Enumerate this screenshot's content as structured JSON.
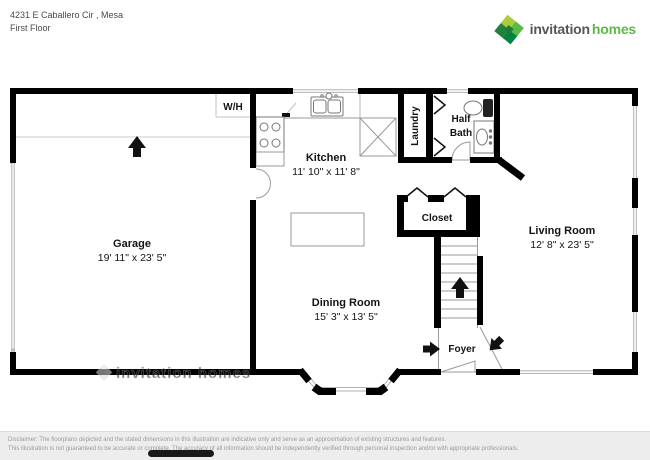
{
  "header": {
    "address": "4231 E Caballero Cir , Mesa",
    "floor": "First Floor"
  },
  "brand": {
    "name_primary": "invitation",
    "name_secondary": "homes",
    "colors": {
      "lime": "#a8cc3a",
      "green": "#5cb947",
      "dark_green": "#00843e",
      "forest": "#23803c",
      "text_gray": "#54565a"
    }
  },
  "plan": {
    "colors": {
      "wall": "#000000",
      "fixture_line": "#777777",
      "window_line": "#b0b0b0"
    },
    "rooms": {
      "garage": {
        "name": "Garage",
        "dims": "19' 11\" x 23' 5\""
      },
      "kitchen": {
        "name": "Kitchen",
        "dims": "11' 10\" x 11' 8\""
      },
      "living_room": {
        "name": "Living Room",
        "dims": "12' 8\" x 23' 5\""
      },
      "dining_room": {
        "name": "Dining Room",
        "dims": "15' 3\" x 13' 5\""
      },
      "laundry": {
        "name": "Laundry"
      },
      "half_bath": {
        "line1": "Half",
        "line2": "Bath"
      },
      "closet": {
        "name": "Closet"
      },
      "foyer": {
        "name": "Foyer"
      },
      "water_heater": {
        "name": "W/H"
      }
    },
    "watermark": "invitation homes"
  },
  "footer": {
    "line1": "Disclaimer: The floorplans depicted and the stated dimensions in this illustration are indicative only and serve as an approximation of existing structures and features.",
    "line2": "This illustration is not guaranteed to be accurate or complete. The accuracy of all information should be independently verified through personal inspection and/or with appropriate professionals."
  }
}
